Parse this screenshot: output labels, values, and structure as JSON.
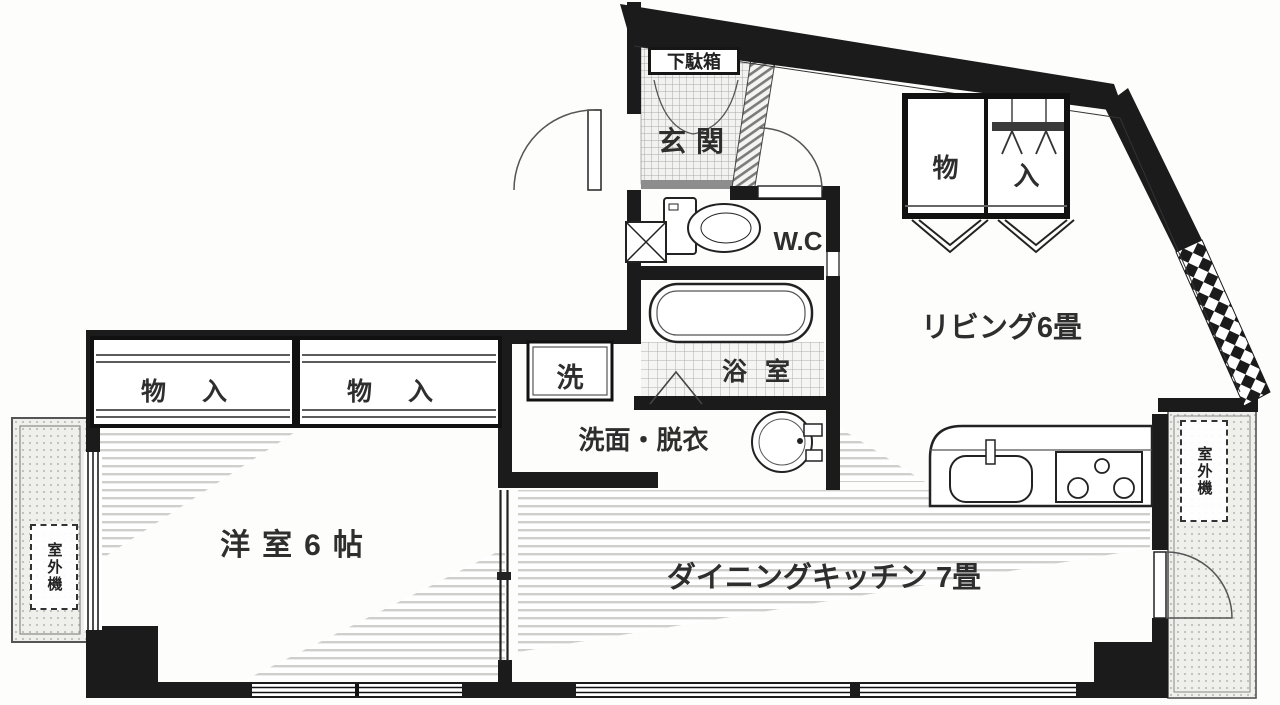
{
  "plan": {
    "genkan": {
      "label": "玄関",
      "shoe_cabinet": "下駄箱"
    },
    "wc": {
      "label": "W.C"
    },
    "bath": {
      "label": "浴室"
    },
    "washroom": {
      "label": "洗面・脱衣",
      "washing_machine": "洗"
    },
    "living": {
      "label": "リビング6畳",
      "closet": {
        "left_char": "物",
        "right_char": "入"
      }
    },
    "bedroom": {
      "label": "洋室6帖",
      "closet_a": "物入",
      "closet_b": "物入"
    },
    "dining_kitchen": {
      "label": "ダイニングキッチン 7畳"
    },
    "balcony_left": {
      "outdoor_unit": "室外機"
    },
    "balcony_right": {
      "outdoor_unit": "室外機"
    }
  },
  "colors": {
    "wall": "#1b1b1b",
    "line": "#333333",
    "text": "#2e2e2e",
    "paper": "#ffffff"
  }
}
